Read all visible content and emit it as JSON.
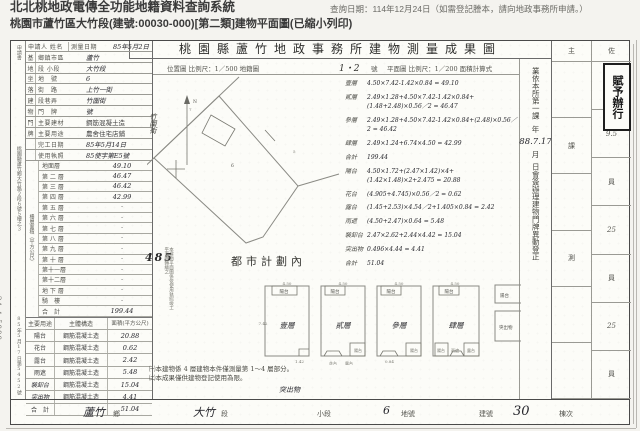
{
  "system_header": {
    "title": "北北桃地政電傳全功能地籍資料查詢系統",
    "query_date": "查詢日期：114年12月24日（如需登記謄本，請向地政事務所申請。）",
    "subtitle": "桃園市蘆竹區大竹段(建號:00030-000)[第二類]建物平面圖(已縮小列印)"
  },
  "doc": {
    "title": "桃園縣蘆竹地政事務所建物測量成果圖",
    "scale_left": "位置圖 比例尺：1／500 地籍圖",
    "sheet_no": "1・2",
    "sheet_unit": "號",
    "scale_right": "平面圖 比例尺：1／200 面積計算式",
    "applicant_label": "申請人 姓名",
    "survey_date_label": "測量日期",
    "survey_date": "85年5月2日",
    "left_strip_top": "申請書",
    "left_strip_mid": "桃園縣蘆竹鄉大竹路２段６號５樓之３",
    "left_strip_bottom": "85年5月17日第5452號",
    "info_rows": [
      {
        "g": "基",
        "l": "鄉鎮市區",
        "v": "蘆竹"
      },
      {
        "g": "地",
        "l": "段 小段",
        "v": "大竹段"
      },
      {
        "g": "坐",
        "l": "地　號",
        "v": "6"
      },
      {
        "g": "落",
        "l": "街　路",
        "v": "上竹一街"
      },
      {
        "g": "建",
        "l": "段巷弄",
        "v": "竹圍街"
      },
      {
        "g": "物",
        "l": "門　牌",
        "v": "號"
      },
      {
        "g": "門",
        "l": "主要建材",
        "v": "鋼筋混凝土造"
      },
      {
        "g": "牌",
        "l": "主要用途",
        "v": "農舍住宅店鋪"
      },
      {
        "g": "",
        "l": "完工日期",
        "v": "85年5月14日"
      },
      {
        "g": "",
        "l": "使用執照",
        "v": "85使字第E5號"
      }
    ],
    "floor_table": {
      "side_label": "樓層面積（平方公尺）",
      "rows": [
        {
          "l": "地面層",
          "v": "49.10"
        },
        {
          "l": "第 二 層",
          "v": "46.47"
        },
        {
          "l": "第 三 層",
          "v": "46.42"
        },
        {
          "l": "第 四 層",
          "v": "42.99"
        },
        {
          "l": "第 五 層",
          "v": "·"
        },
        {
          "l": "第 六 層",
          "v": "·"
        },
        {
          "l": "第 七 層",
          "v": "·"
        },
        {
          "l": "第 八 層",
          "v": "·"
        },
        {
          "l": "第 九 層",
          "v": "·"
        },
        {
          "l": "第 十 層",
          "v": "·"
        },
        {
          "l": "第十一層",
          "v": "·"
        },
        {
          "l": "第十二層",
          "v": "·"
        },
        {
          "l": "地 下 層",
          "v": "·"
        },
        {
          "l": "騎　樓",
          "v": "·"
        },
        {
          "l": "合　計",
          "v": "199.44"
        }
      ]
    },
    "attach_table": {
      "h_use": "主要用途",
      "h_struct": "主體構造",
      "h_area": "面積(平方公尺)",
      "rows": [
        {
          "u": "陽台",
          "s": "鋼筋混凝土造",
          "a": "20.88"
        },
        {
          "u": "花台",
          "s": "鋼筋混凝土造",
          "a": "0.62"
        },
        {
          "u": "露台",
          "s": "鋼筋混凝土造",
          "a": "2.42"
        },
        {
          "u": "雨遮",
          "s": "鋼筋混凝土造",
          "a": "5.48"
        },
        {
          "u": "裝卸台",
          "s": "鋼筋混凝土造",
          "a": "15.04"
        },
        {
          "u": "突出物",
          "s": "鋼筋混凝土造",
          "a": "4.41"
        },
        {
          "u": "合　計",
          "s": "",
          "a": "51.04"
        }
      ]
    },
    "map": {
      "street": "竹圍街",
      "north": "N",
      "parcel": "6",
      "n1": "7",
      "n2": "5",
      "zone": "都市計劃內",
      "stamp": "485",
      "stamp_note": "本建物平面圖係依使用執照竣工平面圖轉繪之"
    },
    "calc_rows": [
      {
        "label": "壹層",
        "expr": "4.50×7.42-1.42×0.84 = 49.10"
      },
      {
        "label": "貳層",
        "expr": "2.49×1.28+4.50×7.42-1.42×0.84+(1.48+2.48)×0.56／2 = 46.47"
      },
      {
        "label": "參層",
        "expr": "2.49×1.28+4.50×7.42-1.42×0.84+(2.48)×0.56／2 = 46.42"
      },
      {
        "label": "肆層",
        "expr": "2.49×1.24+6.74×4.50 = 42.99"
      },
      {
        "label": "合計",
        "expr": "199.44"
      },
      {
        "label": "陽台",
        "expr": "4.50×1.72+(2.47×1.42)×4+(1.42×1.48)×2+2.475 = 20.88"
      },
      {
        "label": "花台",
        "expr": "(4.905+4.745)×0.56／2 = 0.62"
      },
      {
        "label": "露台",
        "expr": "(1.45+2.53)×4.54／2+1.405×0.84 = 2.42"
      },
      {
        "label": "雨遮",
        "expr": "(4.50+2.47)×0.64 = 5.48"
      },
      {
        "label": "裝卸台",
        "expr": "2.47×2.62+2.44×4.42 = 15.04"
      },
      {
        "label": "突出物",
        "expr": "0.496×4.44 = 4.41"
      },
      {
        "label": "合計",
        "expr": "51.04"
      }
    ],
    "memo": {
      "line1": "業依本所第一課",
      "year": "年",
      "date": "88.7.17",
      "month": "月",
      "line2": "日會簽辦理建物門牌異動登正"
    },
    "plans": {
      "f1": "壹層",
      "f2": "貳層",
      "f3": "參層",
      "f4": "肆層",
      "balcony": "陽台",
      "flower": "花台",
      "terrace": "露台",
      "canopy": "雨遮",
      "partial": "突出物",
      "dim_top": "4.50",
      "dim_side": "7.42",
      "dim_a": "1.42",
      "dim_b": "0.84"
    },
    "notes": [
      "㈠本建物係 4 層建物本件僅測量第 1～4 層部分。",
      "㈡本成果僅供建物登記使用為限。"
    ],
    "note_hw": "突出物",
    "sig": {
      "stamp": "賦予辦行",
      "left_header": "主",
      "left": [
        "",
        "課",
        "",
        "測",
        "",
        ""
      ],
      "right_header": "佐",
      "right": [
        "長",
        "9.5",
        "員",
        "25",
        "員",
        "25",
        "員"
      ]
    },
    "bottom_bar": [
      "蘆竹",
      "鄉",
      "大竹",
      "段",
      "小段",
      "6",
      "地號",
      "建號",
      "30",
      "棟次"
    ]
  },
  "margin_no": "24-4-5000"
}
